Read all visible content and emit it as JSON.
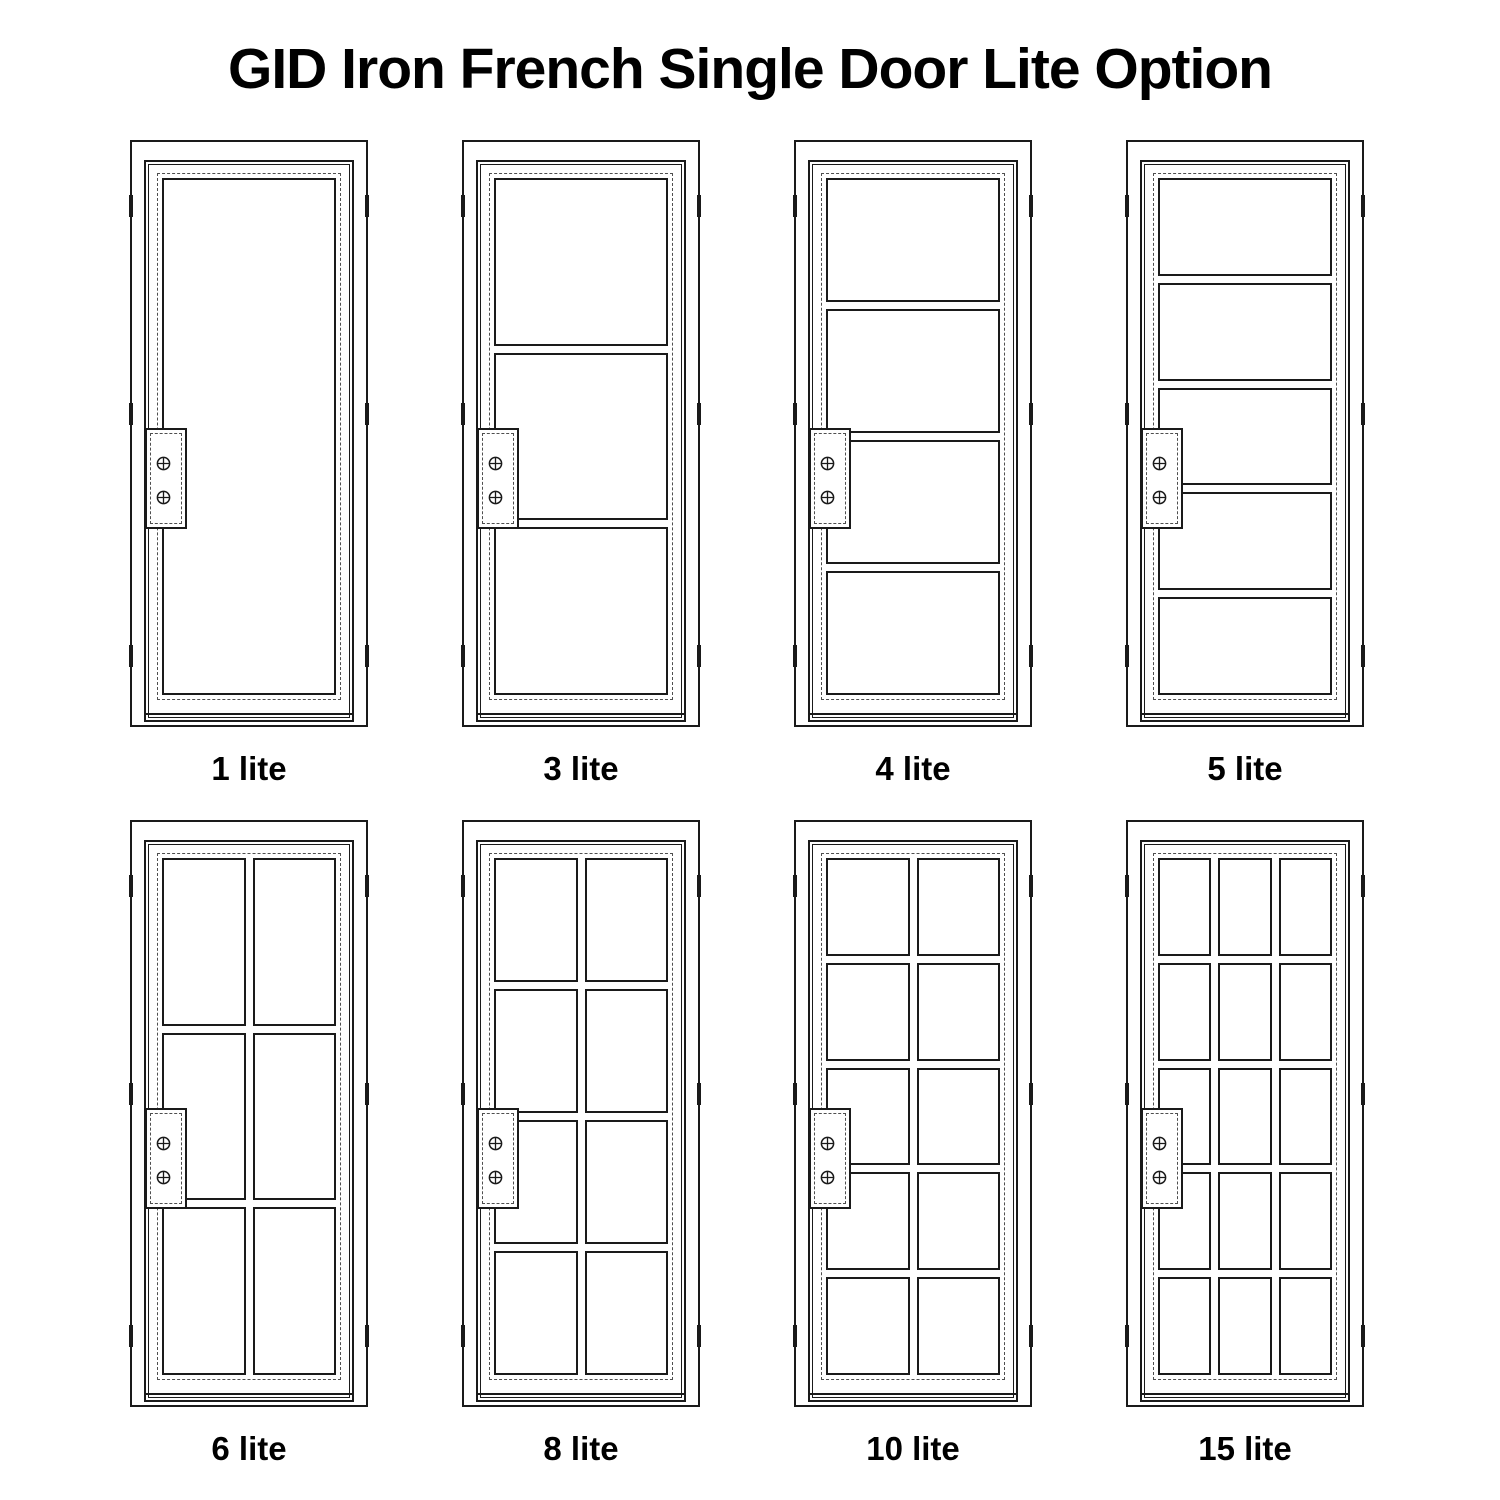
{
  "title": "GID Iron French Single Door Lite Option",
  "colors": {
    "line": "#1a1a1a",
    "dashed": "#4f4f4f",
    "background": "#ffffff",
    "text": "#000000"
  },
  "icons": {
    "screw": "circle-cross",
    "hinge": "tick-mark"
  },
  "hardware": {
    "screws_per_plate": 2,
    "hinge_marks_per_side": 3
  },
  "doors": [
    {
      "label": "1 lite",
      "lites": 1,
      "grid_cols": 1,
      "grid_rows": 1
    },
    {
      "label": "3 lite",
      "lites": 3,
      "grid_cols": 1,
      "grid_rows": 3
    },
    {
      "label": "4 lite",
      "lites": 4,
      "grid_cols": 1,
      "grid_rows": 4
    },
    {
      "label": "5 lite",
      "lites": 5,
      "grid_cols": 1,
      "grid_rows": 5
    },
    {
      "label": "6 lite",
      "lites": 6,
      "grid_cols": 2,
      "grid_rows": 3
    },
    {
      "label": "8 lite",
      "lites": 8,
      "grid_cols": 2,
      "grid_rows": 4
    },
    {
      "label": "10 lite",
      "lites": 10,
      "grid_cols": 2,
      "grid_rows": 5
    },
    {
      "label": "15 lite",
      "lites": 15,
      "grid_cols": 3,
      "grid_rows": 5
    }
  ]
}
